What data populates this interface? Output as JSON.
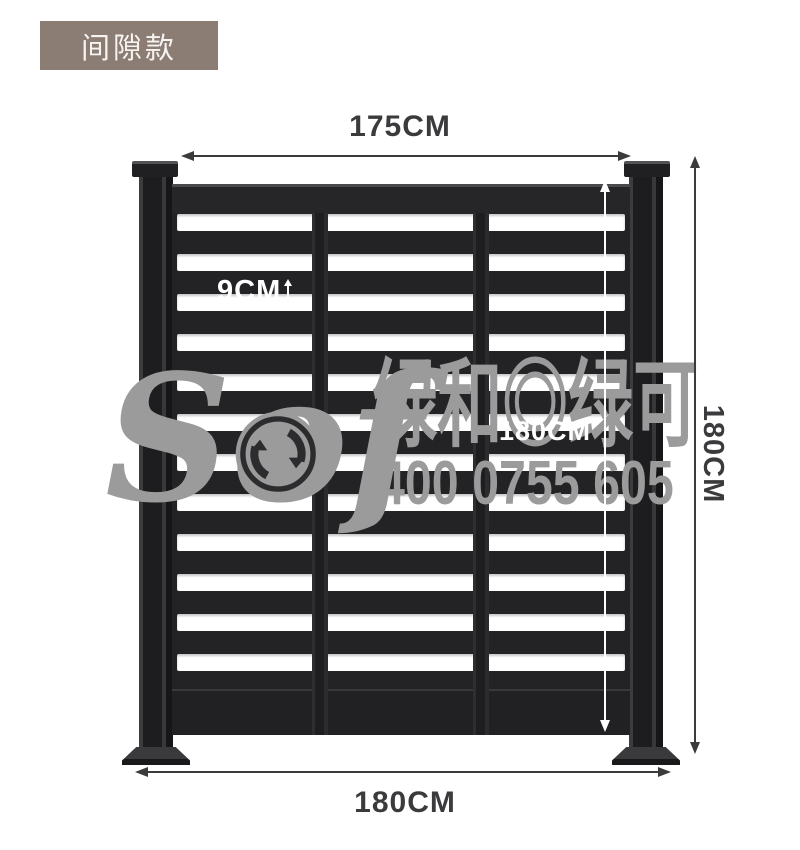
{
  "badge": {
    "label": "间隙款",
    "bg_color": "#8c7d74"
  },
  "annotations": {
    "top_width": "175CM",
    "slat_gap": "9CM",
    "inner_height": "180CM",
    "outer_height": "180CM",
    "base_width": "180CM"
  },
  "watermark": {
    "brand": "Sof",
    "recycle_icon": "recycle-circle-icon",
    "cjk_text": "绿和◎绿可",
    "phone": "400 0755 605",
    "color": "#9b9b9b"
  },
  "fence": {
    "gap_row_count": 12,
    "column_count": 3,
    "colors": {
      "frame": "#232325",
      "gap": "#ffffff",
      "post": "#1d1d1f"
    }
  }
}
